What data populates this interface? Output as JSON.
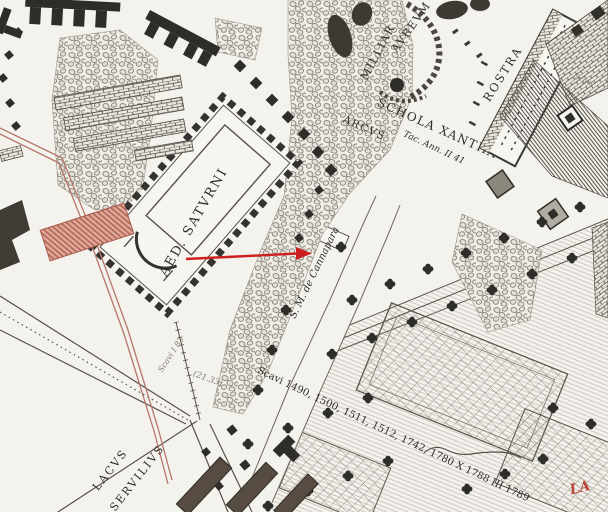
{
  "map": {
    "labels": {
      "aed_saturni": "AED. SATVRNI",
      "milliarium_1": "MILLIAR",
      "milliarium_2": "AVREVM",
      "schola_xantha": "SCHOLA XANTHA",
      "arcus": "ARCVS",
      "arcus_citation": "Tac. Ann. II 41",
      "rostra": "ROSTRA",
      "cannapara": "S. M. de Cannapara",
      "scavi_note": "Scavi I 83",
      "elevation": "(21.33)",
      "scavi_years": "Scavi 1490, 1500, 1511, 1512, 1742, 1780 X 1788 III 1789",
      "lacus_1": "LACVS",
      "lacus_2": "SERVILIVS",
      "red_partial": "LA",
      "scavi_tiny": "Scavi"
    },
    "annotation": {
      "arrow_color": "#cc2020",
      "arrow_direction": "right"
    },
    "colors": {
      "paper": "#f4f2ec",
      "ink": "#2f2d29",
      "red_overlay_line": "#b5766a",
      "red_hatch_fill": "#e0ab9d",
      "red_label": "#b9473a"
    }
  }
}
